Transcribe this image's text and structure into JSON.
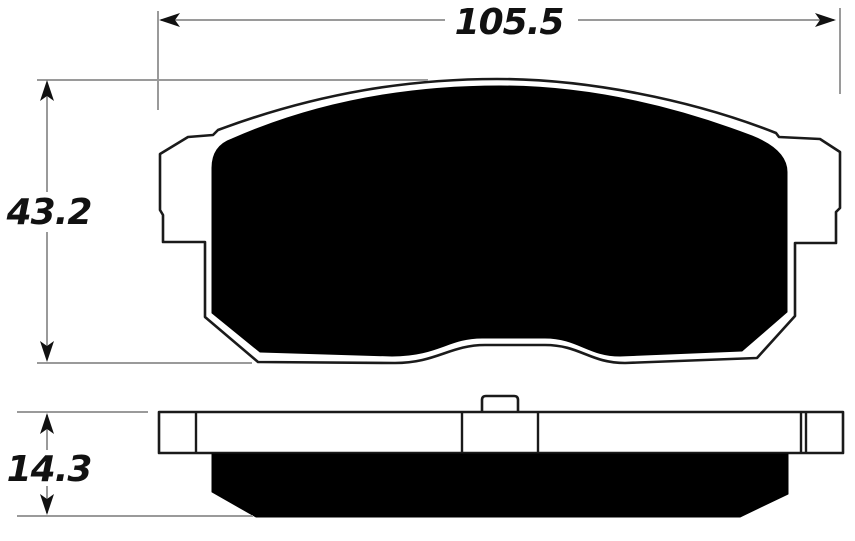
{
  "drawing": {
    "dimensions": {
      "width": {
        "label": "105.5"
      },
      "height": {
        "label": "43.2"
      },
      "thickness": {
        "label": "14.3"
      }
    },
    "colors": {
      "outline": "#1a1a1a",
      "friction": "#000000",
      "dimension_line": "#9a9a9a",
      "text": "#111111",
      "background": "#ffffff"
    }
  }
}
